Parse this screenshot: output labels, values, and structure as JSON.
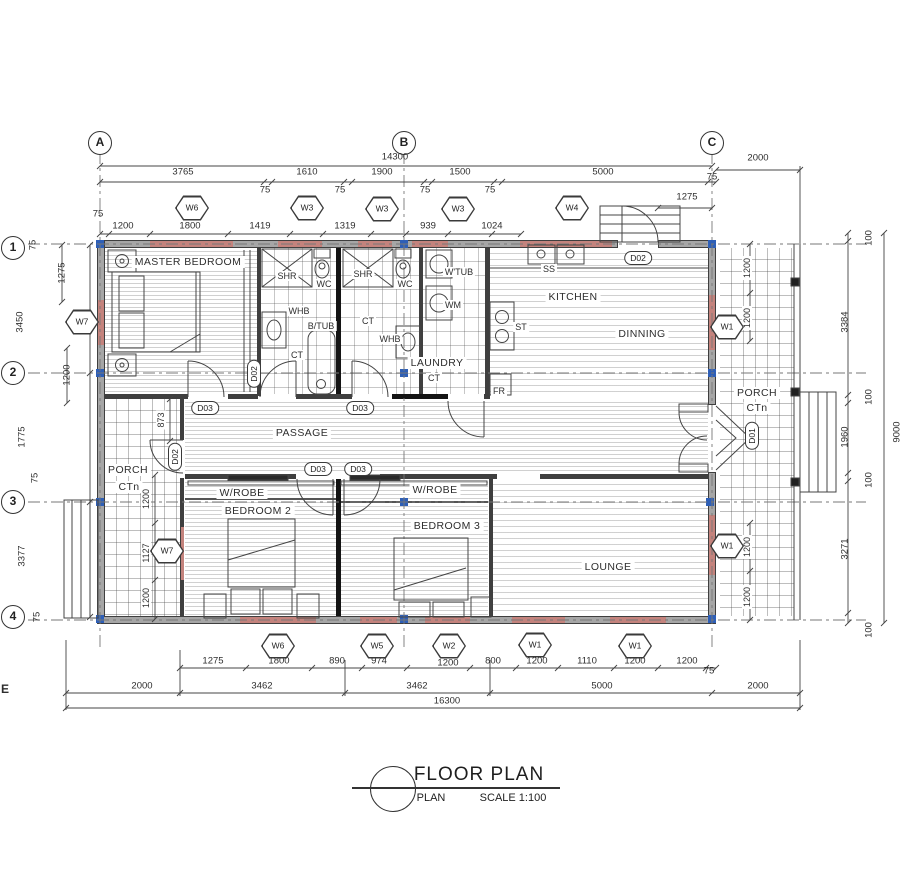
{
  "grid": {
    "cols": [
      "A",
      "B",
      "C"
    ],
    "rows": [
      "1",
      "2",
      "3",
      "4"
    ],
    "edge_label": "E"
  },
  "title_block": {
    "title": "FLOOR PLAN",
    "name": "PLAN",
    "scale": "SCALE 1:100"
  },
  "rooms": {
    "master_bedroom": "MASTER BEDROOM",
    "kitchen": "KITCHEN",
    "dinning": "DINNING",
    "passage": "PASSAGE",
    "lounge": "LOUNGE",
    "bedroom2": "BEDROOM 2",
    "bedroom3": "BEDROOM 3",
    "wrobe": "W/ROBE",
    "porch": "PORCH",
    "ctn": "CTn",
    "laundry": "LAUNDRY"
  },
  "fixtures": {
    "shr": "SHR",
    "wc": "WC",
    "whb": "WHB",
    "btub": "B/TUB",
    "ct": "CT",
    "wtub": "W'TUB",
    "wm": "WM",
    "ss": "SS",
    "st": "ST",
    "fr": "FR"
  },
  "door_tags": {
    "d01": "D01",
    "d02": "D02",
    "d03": "D03"
  },
  "window_tags": {
    "w1": "W1",
    "w2": "W2",
    "w3": "W3",
    "w4": "W4",
    "w5": "W5",
    "w6": "W6",
    "w7": "W7"
  },
  "dims": {
    "top": [
      "14300",
      "3765",
      "1610",
      "1900",
      "1500",
      "5000",
      "2000",
      "75",
      "75",
      "75",
      "75",
      "1275",
      "75",
      "75",
      "1200",
      "1800",
      "1419",
      "1319",
      "939",
      "1024"
    ],
    "bottom": [
      "1275",
      "1800",
      "890",
      "974",
      "1200",
      "800",
      "1200",
      "1110",
      "1200",
      "1200",
      "75",
      "2000",
      "3462",
      "3462",
      "5000",
      "2000",
      "16300"
    ],
    "left": [
      "75",
      "1275",
      "3450",
      "1200",
      "1775",
      "75",
      "3377",
      "75",
      "873",
      "1200",
      "1127",
      "1200"
    ],
    "right": [
      "100",
      "1200",
      "1200",
      "3384",
      "100",
      "1960",
      "100",
      "1200",
      "1200",
      "3271",
      "100",
      "9000"
    ]
  }
}
